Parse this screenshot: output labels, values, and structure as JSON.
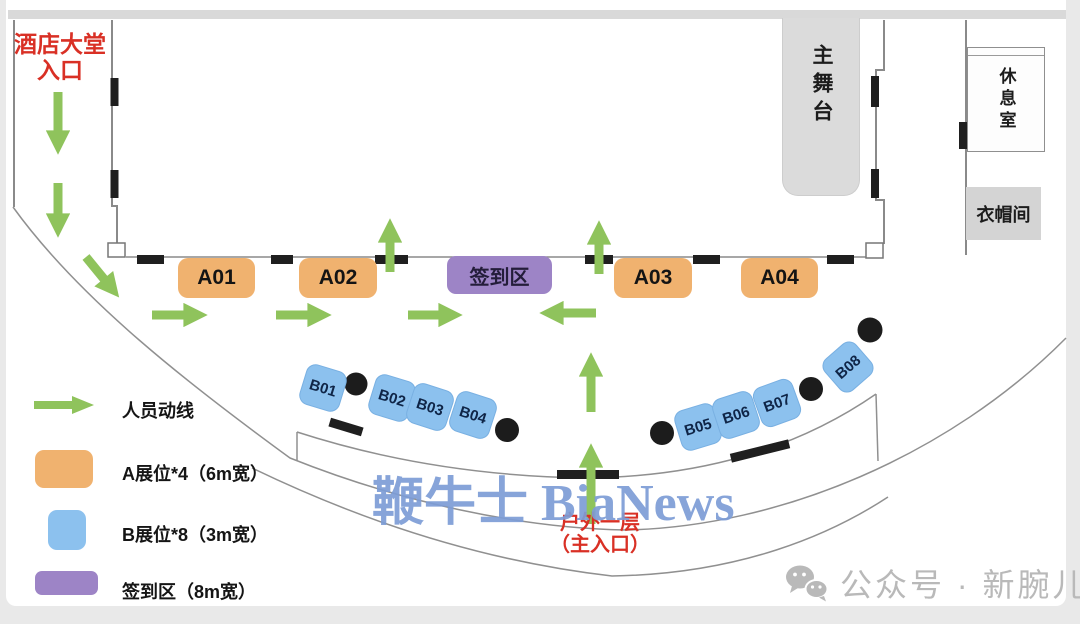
{
  "plan": {
    "hotel_entrance": {
      "line1": "酒店大堂",
      "line2": "入口"
    },
    "main_stage": "主舞台",
    "lounge": "休息室",
    "cloakroom": "衣帽间",
    "checkin_area": "签到区",
    "outdoor_entrance": {
      "line1": "户外一层",
      "line2": "（主入口）"
    },
    "booths_a": [
      "A01",
      "A02",
      "A03",
      "A04"
    ],
    "booths_b": [
      "B01",
      "B02",
      "B03",
      "B04",
      "B05",
      "B06",
      "B07",
      "B08"
    ]
  },
  "legend": {
    "items": [
      {
        "icon": "flow-arrow",
        "label": "人员动线"
      },
      {
        "icon": "booth-a-swatch",
        "label": "A展位*4（6m宽）"
      },
      {
        "icon": "booth-b-swatch",
        "label": "B展位*8（3m宽）"
      },
      {
        "icon": "checkin-swatch",
        "label": "签到区（8m宽）"
      }
    ]
  },
  "watermark": "鞭牛士 BiaNews",
  "footer": {
    "icon": "wechat-icon",
    "text": "公众号 · 新腕儿"
  },
  "colors": {
    "booth_a": "#f0b26f",
    "booth_b": "#8cc1ee",
    "checkin": "#9d84c6",
    "flow_arrow": "#8fc35c",
    "entrance_text": "#d93025",
    "stage_fill": "#dbdbdb",
    "cloakroom_fill": "#d4d4d4",
    "watermark": "#7d9dd6",
    "wall": "#8a8a8a",
    "door": "#1f1f1f",
    "footer_text": "#b9b9b9"
  }
}
